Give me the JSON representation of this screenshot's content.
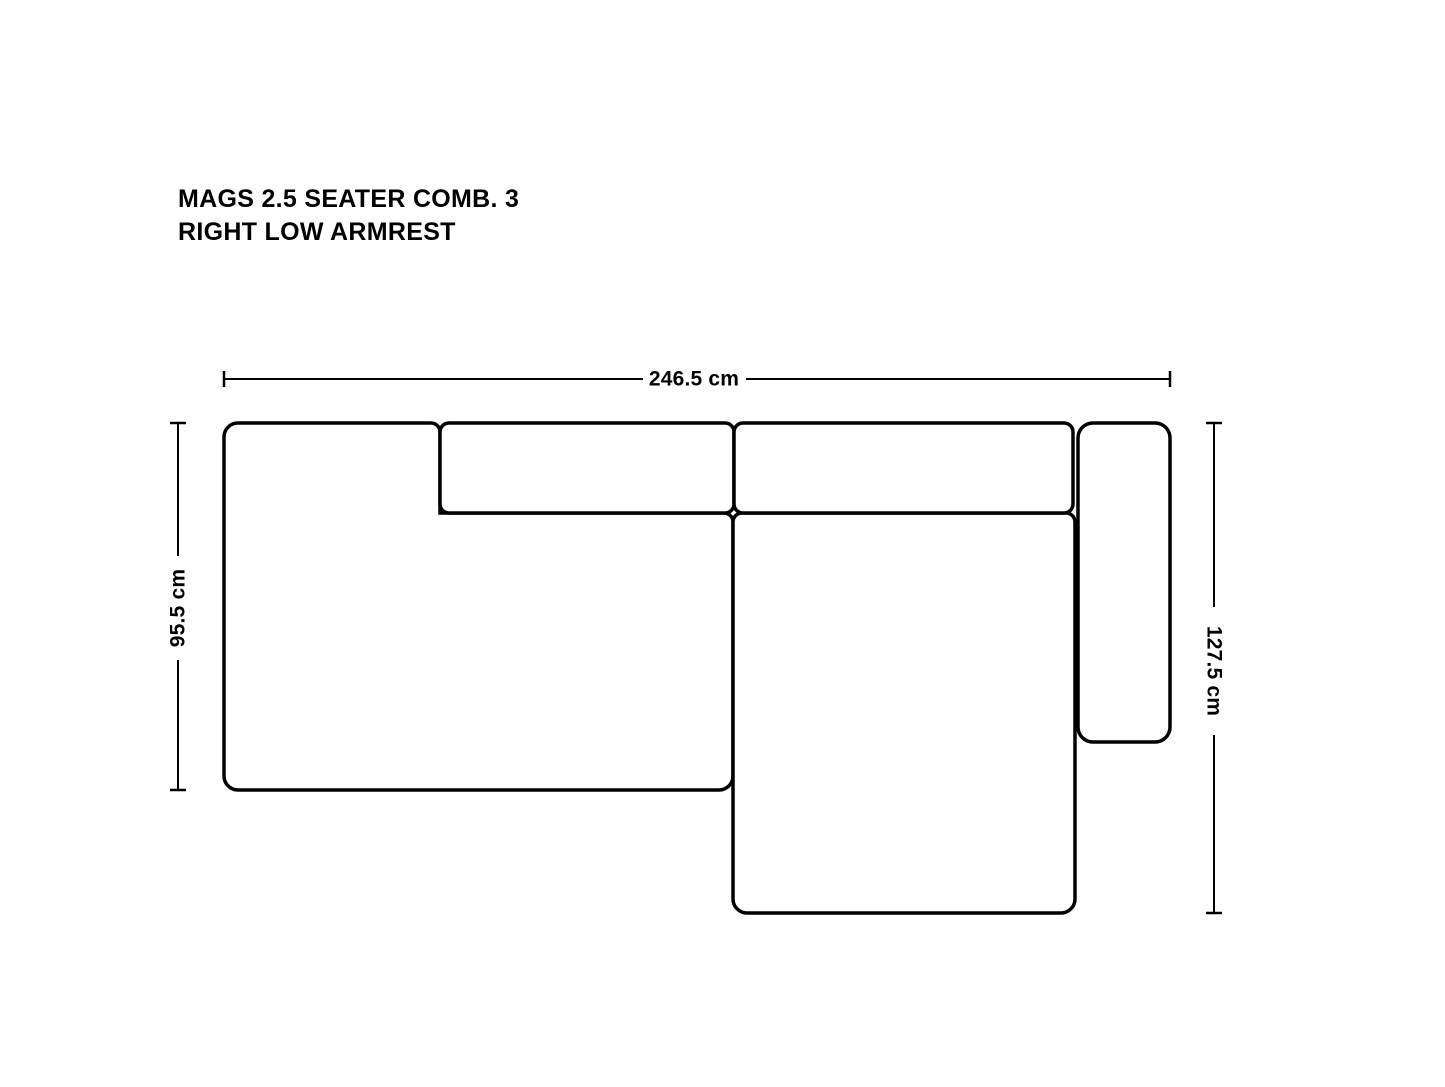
{
  "title": {
    "line1": "MAGS 2.5 SEATER COMB. 3",
    "line2": "RIGHT LOW ARMREST"
  },
  "dimensions": {
    "overall_width": "246.5 cm",
    "left_depth": "95.5 cm",
    "chaise_depth": "127.5 cm"
  },
  "colors": {
    "outline": "#000000",
    "text": "#000000",
    "background": "#ffffff"
  }
}
